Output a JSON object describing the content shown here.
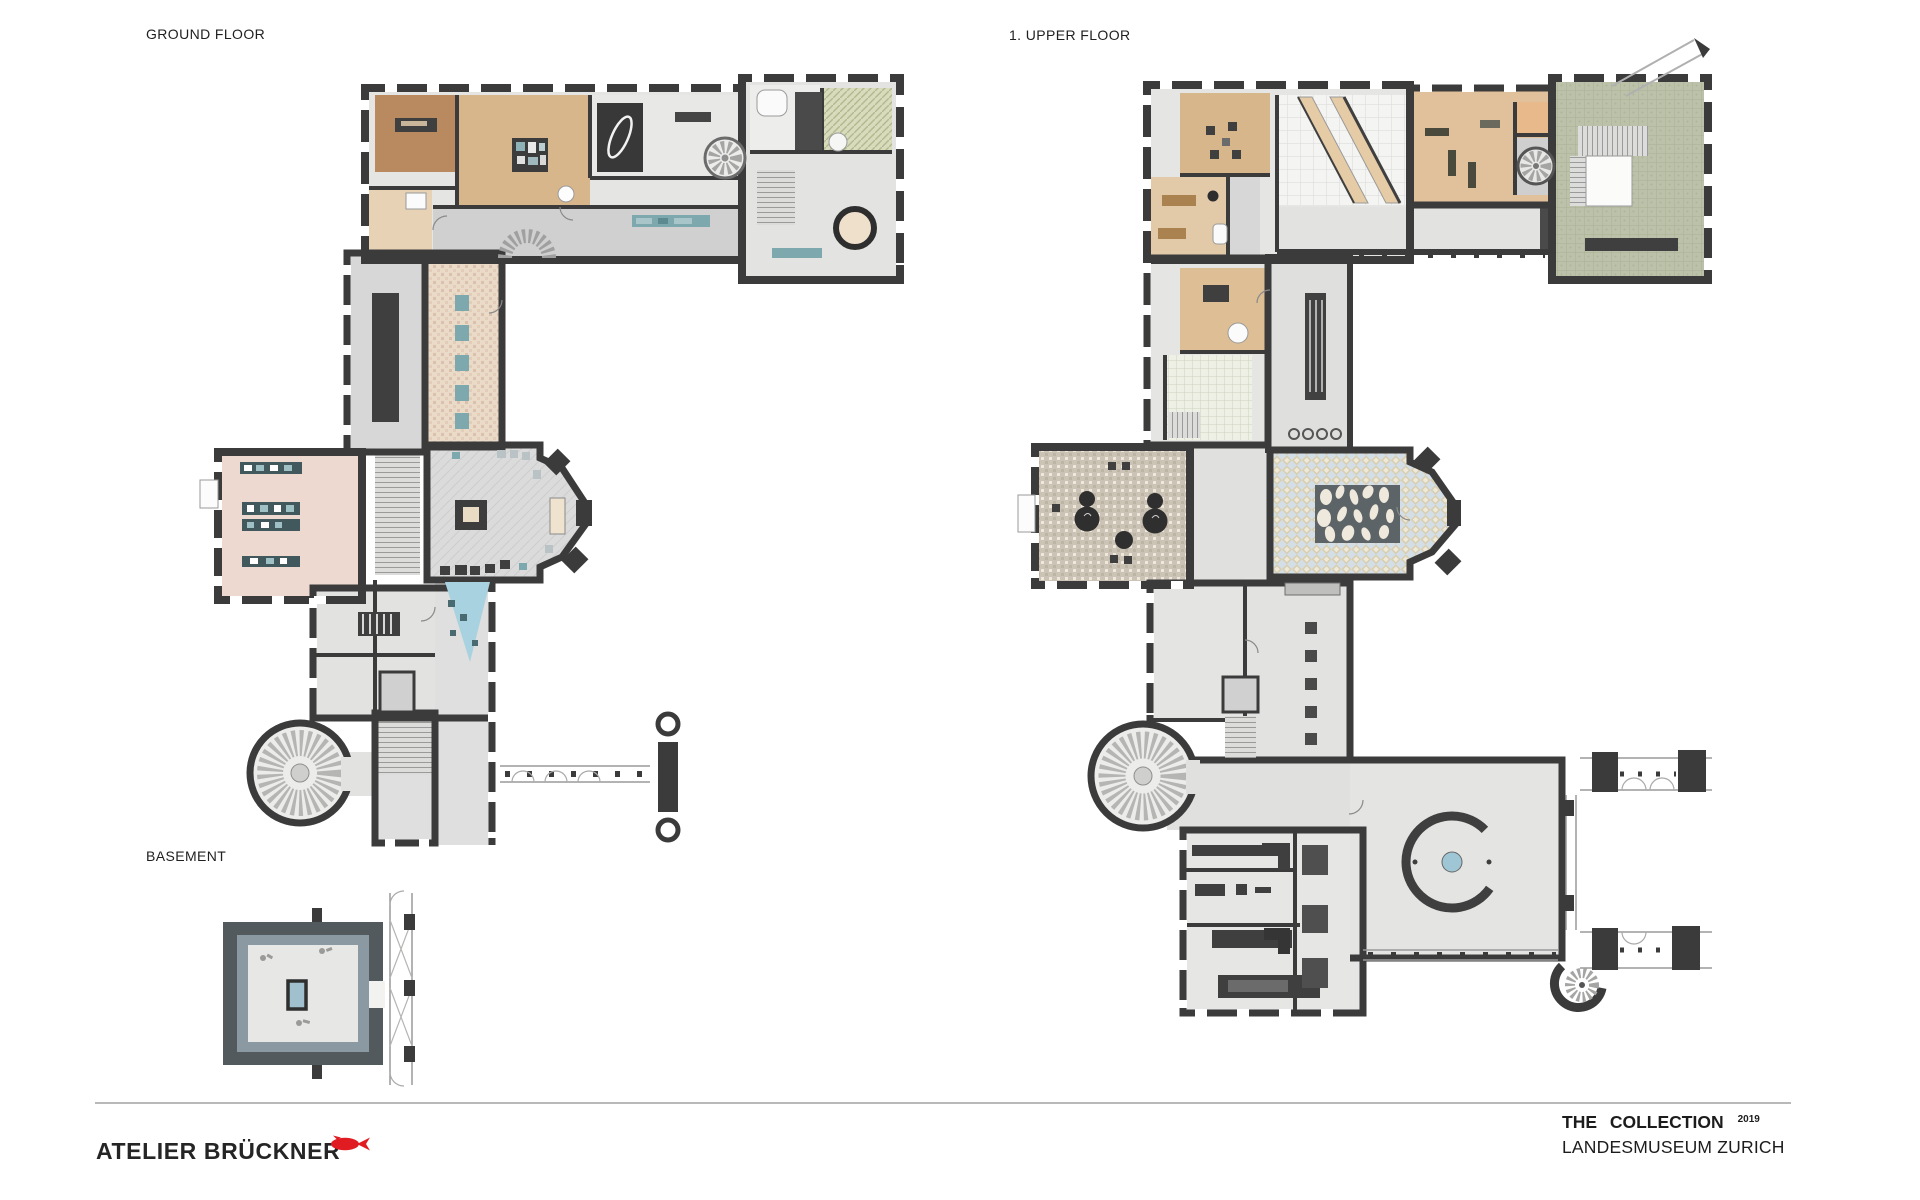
{
  "sheet": {
    "type": "architectural floor plan presentation sheet",
    "labels": {
      "ground": "GROUND FLOOR",
      "upper": "1. UPPER FLOOR",
      "basement": "BASEMENT"
    },
    "footer": {
      "studio": "ATELIER BRÜCKNER",
      "logo_icon": "fish-icon",
      "project_title": "THE COLLECTION",
      "project_year": "2019",
      "project_subtitle": "LANDESMUSEUM ZURICH"
    }
  },
  "palette": {
    "ink": "#1f1f1f",
    "brand-red": "#e01b22",
    "wall-dark": "#3b3b3b",
    "floor-light": "#e5e5e3",
    "floor-mid": "#d2d3d2",
    "wood-dark": "#b98a5f",
    "wood": "#d8b68c",
    "wood-pale": "#e7d2b6",
    "room-pink": "#eed9d1",
    "room-sage": "#bcc2a9",
    "room-olive": "#d9dbbd",
    "diamond-blue": "#d3dee6",
    "diamond-beige": "#d8ceb0",
    "taupe": "#cbc3b5",
    "teal-case": "#7da9ae",
    "slate": "#8b9aa2",
    "water-blue": "#a8d2e0"
  }
}
